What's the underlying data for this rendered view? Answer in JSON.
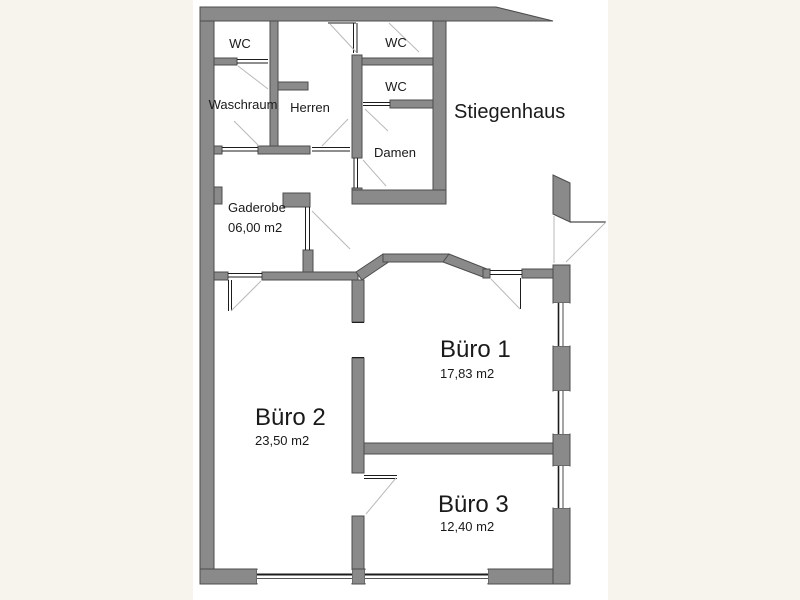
{
  "colors": {
    "background": "#f7f4ee",
    "panel": "#ffffff",
    "wall_fill": "#8a8a8a",
    "wall_outline": "#4c4c4c",
    "door_swing": "#b9b9b9",
    "detail_line": "#1c1c1c",
    "text": "#1a1a1a"
  },
  "rooms": {
    "wc_top_left": {
      "name": "WC"
    },
    "waschraum": {
      "name": "Waschraum"
    },
    "herren": {
      "name": "Herren"
    },
    "wc_right_upper": {
      "name": "WC"
    },
    "wc_right_lower": {
      "name": "WC"
    },
    "damen": {
      "name": "Damen"
    },
    "stiegenhaus": {
      "name": "Stiegenhaus"
    },
    "gaderobe": {
      "name": "Gaderobe",
      "area": "06,00 m2"
    },
    "buero_1": {
      "name": "Büro 1",
      "area": "17,83 m2"
    },
    "buero_2": {
      "name": "Büro 2",
      "area": "23,50 m2"
    },
    "buero_3": {
      "name": "Büro 3",
      "area": "12,40 m2"
    }
  }
}
